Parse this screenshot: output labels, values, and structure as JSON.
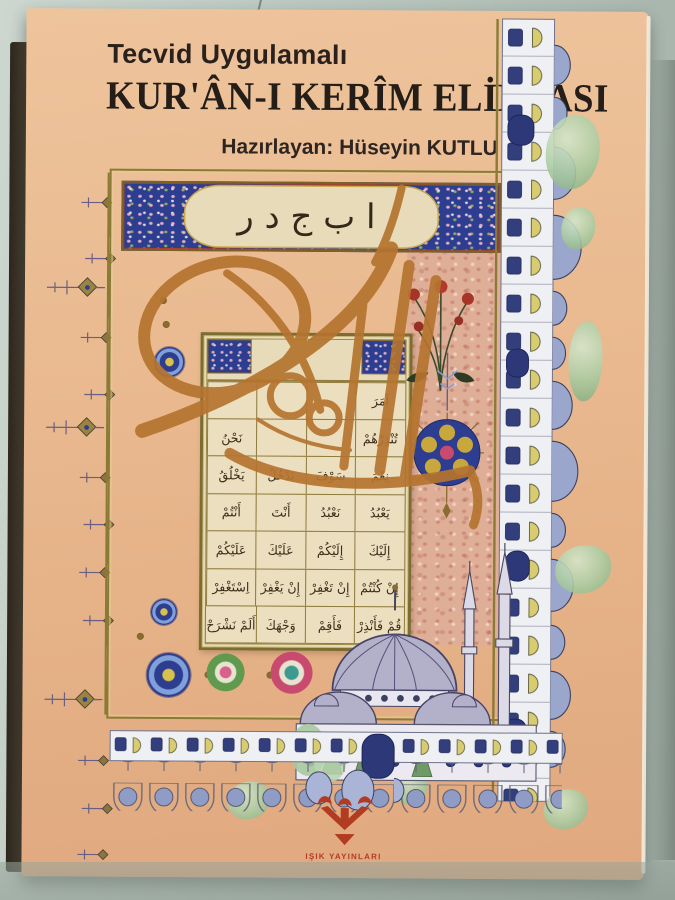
{
  "cover": {
    "series_title": "Tecvid Uygulamalı",
    "main_title": "KUR'ÂN-I KERÎM ELİFBASI",
    "author_line": "Hazırlayan: Hüseyin KUTLU",
    "header_panel": {
      "letters": "ا ب ج د ر"
    },
    "elifba_grid": {
      "rows": [
        [
          "آمَرَ",
          "",
          "",
          ""
        ],
        [
          "تُنْذِرْهُمْ",
          "",
          "",
          "نَحْنُ"
        ],
        [
          "نِعْمَ",
          "سَوْفَ",
          "يَدْخُلُ",
          "يَخْلُقُ"
        ],
        [
          "يَعْبُدُ",
          "نَعْبُدُ",
          "أَنْتَ",
          "أَنْتُمْ"
        ],
        [
          "إِلَيْكَ",
          "إِلَيْكُمْ",
          "عَلَيْكَ",
          "عَلَيْكُمْ"
        ],
        [
          "إِنْ كُنْتُمْ",
          "إِنْ تَغْفِرْ",
          "إِنْ يَغْفِرْ",
          "اِسْتَغْفِرْ"
        ],
        [
          "قُمْ فَأَنْذِرْ",
          "فَأَقِمْ",
          "وَجْهَكَ",
          "أَلَمْ نَشْرَحْ"
        ]
      ]
    },
    "publisher": {
      "name": "IŞIK YAYINLARI"
    }
  },
  "colors": {
    "cover_bg": "#e9b88e",
    "title_ink": "#2b211c",
    "frame_gold": "#8a7a36",
    "header_blue": "#2d3d90",
    "page_cream": "#e8dbb9",
    "calligraphy": "#b5742f",
    "dome_blue": "#b3b0ca",
    "window_blue": "#323f7c",
    "arch_white": "#eef0f4",
    "arch_yellow": "#d9cb6f",
    "tree_green": "#8fb489",
    "logo_red": "#b23c22",
    "table_gray": "#b7c3bb",
    "spine_brown": "#42382a"
  }
}
